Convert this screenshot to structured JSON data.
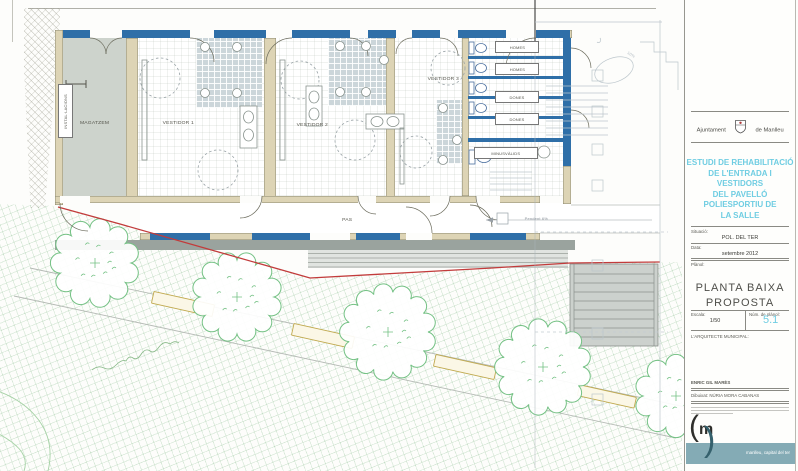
{
  "drawing": {
    "labels": {
      "installacions": "INSTAL·LACIONS",
      "magatzem": "MAGATZEM",
      "vestidor1": "VESTIDOR 1",
      "vestidor2": "VESTIDOR 2",
      "vestidor3": "VESTIDOR 3",
      "homes_a": "HOMES",
      "homes_b": "HOMES",
      "dones_a": "DONES",
      "dones_b": "DONES",
      "minusvalids": "MINUSVÀLIDS",
      "pas": "PAS"
    },
    "annotations": {
      "pendent_pas": "Pendent 6%",
      "pendent_ramp": "10%"
    }
  },
  "title_block": {
    "org_name_left": "Ajuntament",
    "org_name_right": "de Manlleu",
    "project_title_lines": [
      "ESTUDI DE REHABILITACIÓ",
      "DE L'ENTRADA I VESTIDORS",
      "DEL PAVELLÓ",
      "POLIESPORTIU DE",
      "LA SALLE"
    ],
    "situacio_label": "Situació:",
    "situacio_value": "POL. DEL TER",
    "data_label": "Data:",
    "data_value": "setembre 2012",
    "planol_label": "Plànol:",
    "plan_name_line1": "PLANTA BAIXA",
    "plan_name_line2": "PROPOSTA",
    "escala_label": "Escala:",
    "escala_value": "1/50",
    "num_planol_label": "Núm. de plànol:",
    "num_planol_value": "5.1",
    "architect_label": "L'ARQUITECTE MUNICIPAL:",
    "architect_name": "ENRIC GIL MARÈS",
    "drawn_by": "Dibuixat: NÚRIA MORA CABANAS",
    "logo_letter": "m",
    "tagline": "manlleu, capital del ter"
  },
  "colors": {
    "wall_new_blue": "#2f6fa8",
    "wall_existing_tan": "#ddd4b5",
    "boundary_red": "#c23b3b",
    "tree_green": "#74c184",
    "bench_yellow": "#c0a94e",
    "title_cyan": "#6fcde2",
    "band_teal": "#84abb5"
  }
}
